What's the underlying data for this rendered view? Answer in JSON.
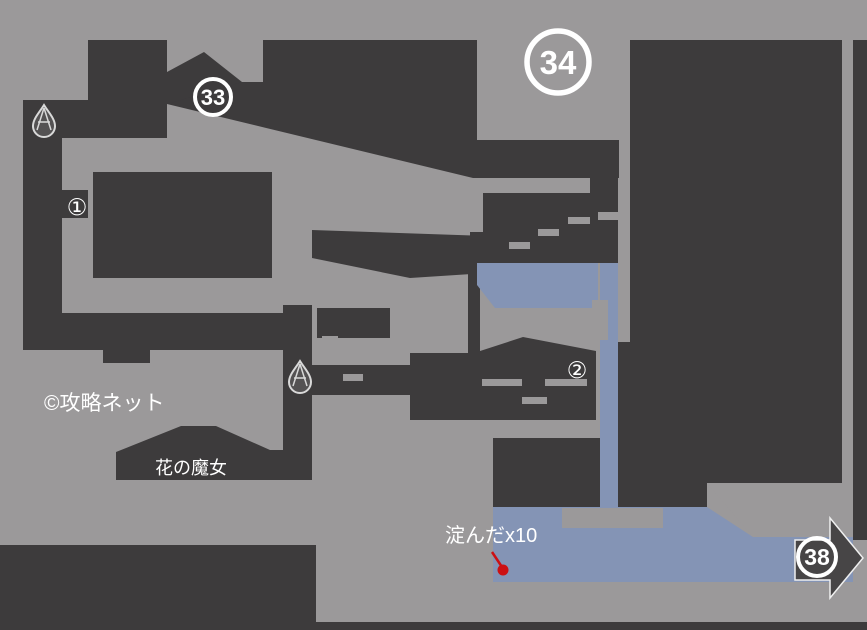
{
  "map": {
    "labels": {
      "credit": "©攻略ネット",
      "boss": "花の魔女",
      "item_drop": "淀んだx10"
    },
    "markers": {
      "gate33": "33",
      "gate34": "34",
      "gate38": "38",
      "item1": "①",
      "item2": "②"
    },
    "icons": {
      "droplet1": "water-drop",
      "droplet2": "water-drop",
      "exit_arrow": "arrow-right"
    },
    "colors": {
      "background": "#9b999a",
      "structure": "#3d3b3c",
      "water": "#8494b5",
      "white": "#ffffff",
      "red": "#cc1013",
      "arrow": "#474546",
      "droplet": "#d9d9d9"
    }
  }
}
